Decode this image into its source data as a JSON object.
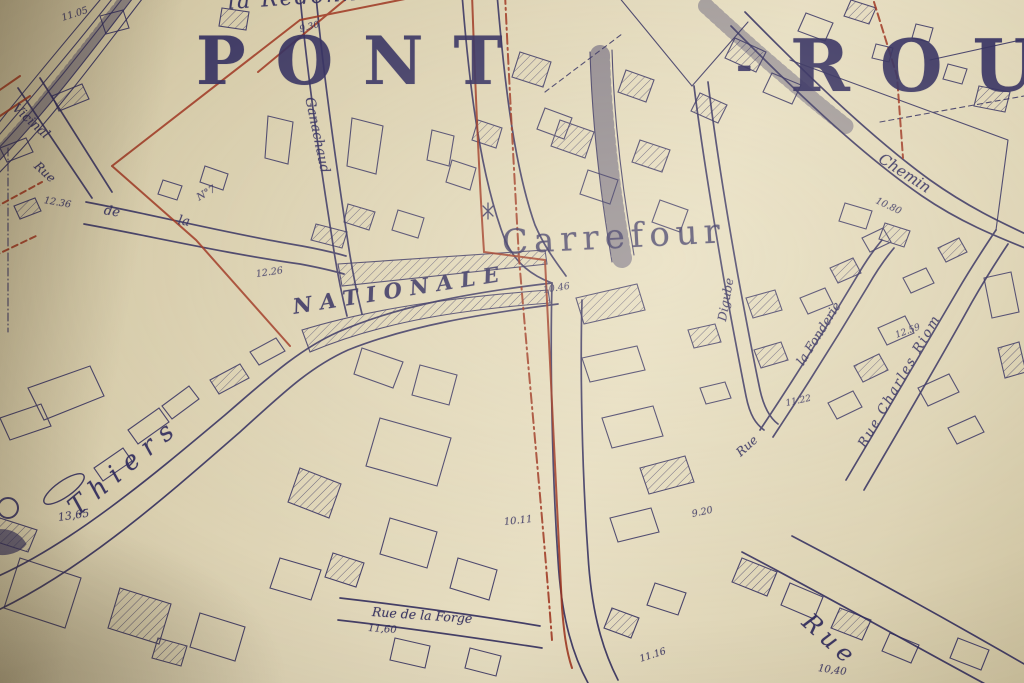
{
  "colors": {
    "paper": "#ddd3b4",
    "ink": "#2e2a5c",
    "red": "#9b2f1b"
  },
  "title": {
    "part1": "PONT",
    "separator": "-",
    "part2": "ROU",
    "note_kind": "town-name-partially-cut-at-right-edge"
  },
  "labels": [
    {
      "kind": "place-name",
      "text": "la Redonnière"
    },
    {
      "kind": "spot-elevation",
      "text": "9.30"
    },
    {
      "kind": "spot-elevation",
      "text": "11.05"
    },
    {
      "kind": "street-name",
      "text": "Vicinal"
    },
    {
      "kind": "street-name",
      "text": "Rue"
    },
    {
      "kind": "spot-elevation",
      "text": "12.36"
    },
    {
      "kind": "street-name",
      "text": "de"
    },
    {
      "kind": "street-name",
      "text": "la"
    },
    {
      "kind": "parcel-number",
      "text": "N°7"
    },
    {
      "kind": "street-name",
      "text": "Ganachaud"
    },
    {
      "kind": "spot-elevation",
      "text": "12.26"
    },
    {
      "kind": "street-name",
      "text": "NATIONALE"
    },
    {
      "kind": "spot-elevation",
      "text": "10.46"
    },
    {
      "kind": "place-name",
      "text": "Carrefour"
    },
    {
      "kind": "street-name",
      "text": "Chemin"
    },
    {
      "kind": "spot-elevation",
      "text": "10.80"
    },
    {
      "kind": "street-name",
      "text": "Digube"
    },
    {
      "kind": "street-name",
      "text": "la Fonderie"
    },
    {
      "kind": "spot-elevation",
      "text": "12.59"
    },
    {
      "kind": "street-name",
      "text": "Rue Charles Riom"
    },
    {
      "kind": "spot-elevation",
      "text": "11.22"
    },
    {
      "kind": "street-name",
      "text": "Rue"
    },
    {
      "kind": "spot-elevation",
      "text": "9.20"
    },
    {
      "kind": "spot-elevation",
      "text": "10.11"
    },
    {
      "kind": "spot-elevation",
      "text": "13,65"
    },
    {
      "kind": "street-name",
      "text": "Thiers"
    },
    {
      "kind": "street-name",
      "text": "Rue de la Forge"
    },
    {
      "kind": "spot-elevation",
      "text": "11,60"
    },
    {
      "kind": "spot-elevation",
      "text": "11.16"
    },
    {
      "kind": "street-name",
      "text": "Rue"
    },
    {
      "kind": "spot-elevation",
      "text": "10,40"
    }
  ]
}
